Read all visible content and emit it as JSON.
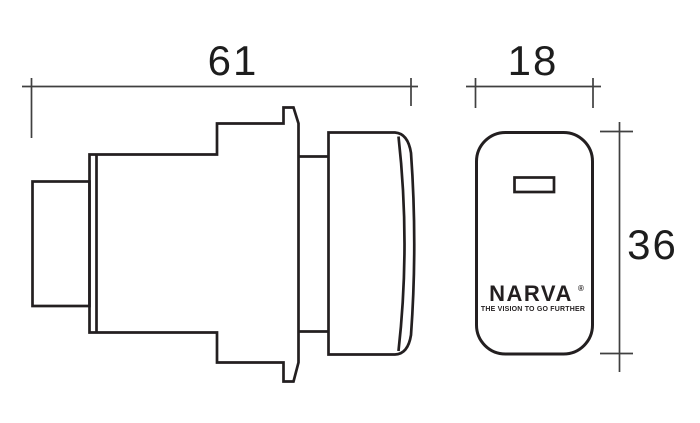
{
  "drawing": {
    "type": "product-dimension-diagram",
    "colors": {
      "outline": "#231f20",
      "dimension_line": "#404040",
      "background": "#ffffff"
    },
    "dimensions": {
      "side_width": "61",
      "front_width": "18",
      "front_height": "36"
    },
    "front_view": {
      "logo": "NARVA",
      "registered_mark": "®",
      "tagline": "THE VISION TO GO FURTHER"
    }
  }
}
